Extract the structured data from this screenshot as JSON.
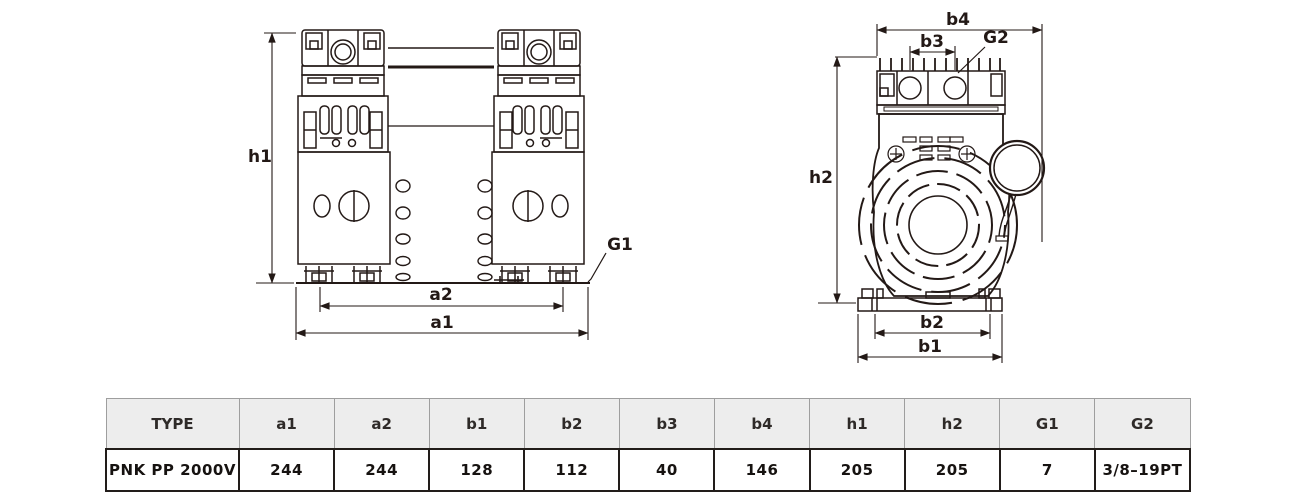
{
  "colors": {
    "line": "#231916",
    "table_header_bg": "#ededed",
    "table_header_border": "#9e9e9e",
    "table_body_border": "#221d1a"
  },
  "front_view": {
    "dims": {
      "h1": "h1",
      "a2": "a2",
      "a1": "a1",
      "G1": "G1"
    }
  },
  "side_view": {
    "dims": {
      "b4": "b4",
      "b3": "b3",
      "G2": "G2",
      "h2": "h2",
      "b2": "b2",
      "b1": "b1"
    }
  },
  "table": {
    "headers": [
      "TYPE",
      "a1",
      "a2",
      "b1",
      "b2",
      "b3",
      "b4",
      "h1",
      "h2",
      "G1",
      "G2"
    ],
    "row": [
      "PNK PP 2000V",
      "244",
      "244",
      "128",
      "112",
      "40",
      "146",
      "205",
      "205",
      "7",
      "3/8–19PT"
    ]
  }
}
